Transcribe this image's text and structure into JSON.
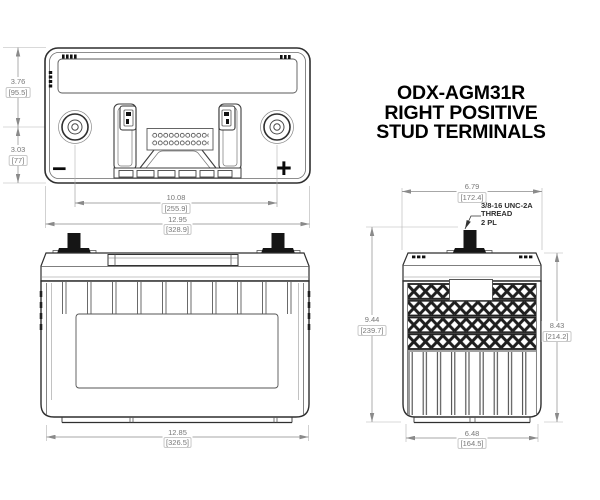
{
  "title": {
    "line1": "ODX-AGM31R",
    "line2": "RIGHT POSITIVE",
    "line3": "STUD TERMINALS"
  },
  "top_view": {
    "negative_symbol": "−",
    "positive_symbol": "+",
    "dim_height_upper": {
      "in": "3.76",
      "mm": "[95.5]"
    },
    "dim_height_lower": {
      "in": "3.03",
      "mm": "[77]"
    },
    "dim_terminal_spacing": {
      "in": "10.08",
      "mm": "[255.9]"
    },
    "dim_overall_width": {
      "in": "12.95",
      "mm": "[328.9]"
    }
  },
  "front_view": {
    "dim_overall_width": {
      "in": "12.85",
      "mm": "[326.5]"
    }
  },
  "side_view": {
    "dim_top_width": {
      "in": "6.79",
      "mm": "[172.4]"
    },
    "dim_overall_height": {
      "in": "9.44",
      "mm": "[239.7]"
    },
    "dim_case_height": {
      "in": "8.43",
      "mm": "[214.2]"
    },
    "dim_bottom_width": {
      "in": "6.48",
      "mm": "[164.5]"
    },
    "thread_note": {
      "line1": "3/8-16 UNC-2A",
      "line2": "THREAD",
      "line3": "2 PL"
    }
  },
  "colors": {
    "outline": "#2f2f2f",
    "secondary_line": "#555555",
    "dimension_line": "#8a8a8a",
    "dimension_text": "#787878",
    "terminal_fill": "#151515",
    "title_text": "#000000"
  }
}
